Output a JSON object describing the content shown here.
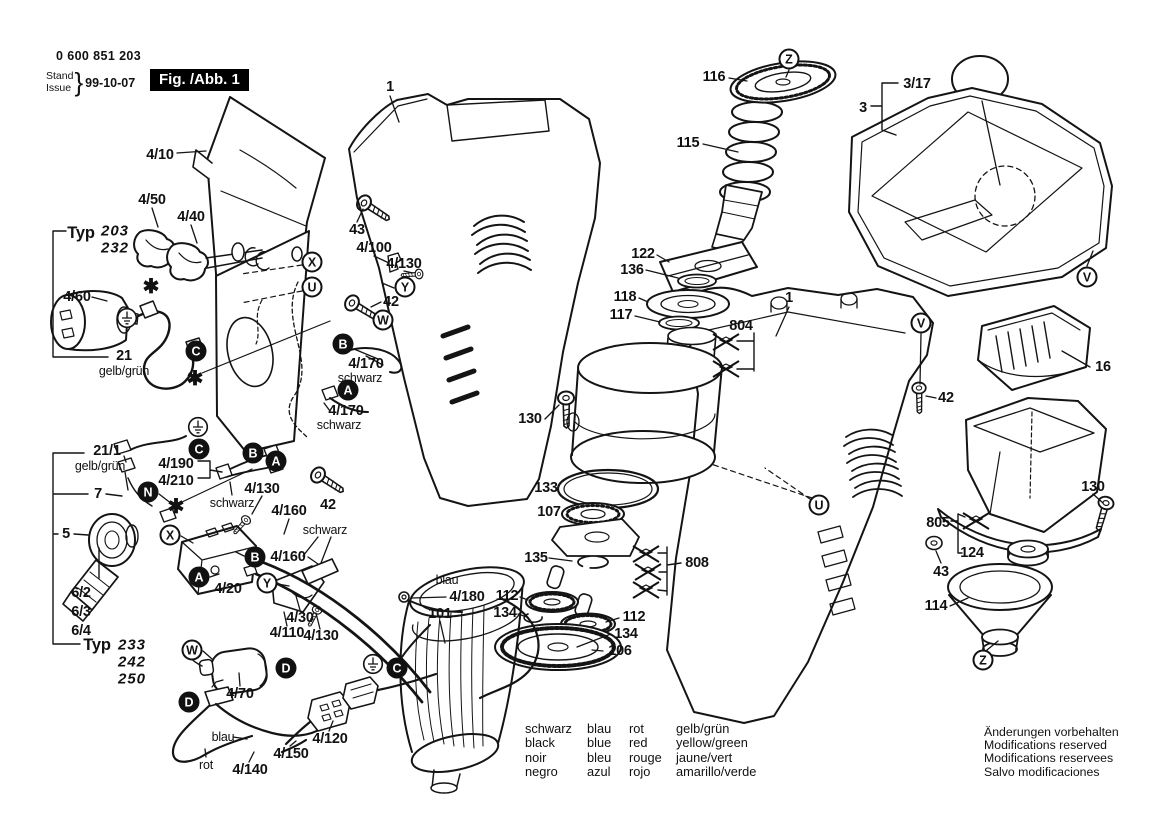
{
  "meta": {
    "part_number": "0 600 851 203",
    "stand_label": "Stand",
    "issue_label": "Issue",
    "brace": "}",
    "date": "99-10-07",
    "figure_label": "Fig. /Abb. 1"
  },
  "colors": {
    "ink": "#141414",
    "paper": "#ffffff"
  },
  "callouts": [
    {
      "text": "4/10",
      "x": 160,
      "y": 155,
      "style": "part"
    },
    {
      "text": "4/50",
      "x": 152,
      "y": 200,
      "style": "part"
    },
    {
      "text": "4/40",
      "x": 191,
      "y": 217,
      "style": "part"
    },
    {
      "text": "Typ",
      "x": 81,
      "y": 233,
      "style": "typ"
    },
    {
      "text": "203",
      "x": 115,
      "y": 231,
      "style": "typnum"
    },
    {
      "text": "232",
      "x": 115,
      "y": 248,
      "style": "typnum"
    },
    {
      "text": "4/60",
      "x": 77,
      "y": 297,
      "style": "part"
    },
    {
      "text": "21",
      "x": 124,
      "y": 356,
      "style": "part"
    },
    {
      "text": "gelb/grün",
      "x": 124,
      "y": 371,
      "style": "color"
    },
    {
      "text": "21/1",
      "x": 107,
      "y": 451,
      "style": "part"
    },
    {
      "text": "gelb/grün",
      "x": 100,
      "y": 466,
      "style": "color"
    },
    {
      "text": "7",
      "x": 98,
      "y": 494,
      "style": "part"
    },
    {
      "text": "5",
      "x": 66,
      "y": 534,
      "style": "part"
    },
    {
      "text": "6/2",
      "x": 81,
      "y": 593,
      "style": "part"
    },
    {
      "text": "6/3",
      "x": 81,
      "y": 612,
      "style": "part"
    },
    {
      "text": "6/4",
      "x": 81,
      "y": 631,
      "style": "part"
    },
    {
      "text": "Typ",
      "x": 97,
      "y": 645,
      "style": "typ"
    },
    {
      "text": "233",
      "x": 132,
      "y": 645,
      "style": "typnum"
    },
    {
      "text": "242",
      "x": 132,
      "y": 662,
      "style": "typnum"
    },
    {
      "text": "250",
      "x": 132,
      "y": 679,
      "style": "typnum"
    },
    {
      "text": "4/190",
      "x": 176,
      "y": 464,
      "style": "part"
    },
    {
      "text": "4/210",
      "x": 176,
      "y": 481,
      "style": "part"
    },
    {
      "text": "schwarz",
      "x": 232,
      "y": 503,
      "style": "color"
    },
    {
      "text": "4/130",
      "x": 262,
      "y": 489,
      "style": "part"
    },
    {
      "text": "4/160",
      "x": 289,
      "y": 511,
      "style": "part"
    },
    {
      "text": "schwarz",
      "x": 325,
      "y": 530,
      "style": "color"
    },
    {
      "text": "4/160",
      "x": 288,
      "y": 557,
      "style": "part"
    },
    {
      "text": "4/20",
      "x": 228,
      "y": 589,
      "style": "part"
    },
    {
      "text": "4/30",
      "x": 300,
      "y": 618,
      "style": "part"
    },
    {
      "text": "4/110",
      "x": 287,
      "y": 633,
      "style": "part"
    },
    {
      "text": "4/130",
      "x": 321,
      "y": 636,
      "style": "part"
    },
    {
      "text": "4/70",
      "x": 240,
      "y": 694,
      "style": "part"
    },
    {
      "text": "blau",
      "x": 223,
      "y": 737,
      "style": "color"
    },
    {
      "text": "rot",
      "x": 206,
      "y": 765,
      "style": "color"
    },
    {
      "text": "4/140",
      "x": 250,
      "y": 770,
      "style": "part"
    },
    {
      "text": "4/150",
      "x": 291,
      "y": 754,
      "style": "part"
    },
    {
      "text": "4/120",
      "x": 330,
      "y": 739,
      "style": "part"
    },
    {
      "text": "blau",
      "x": 447,
      "y": 580,
      "style": "color"
    },
    {
      "text": "4/180",
      "x": 467,
      "y": 597,
      "style": "part"
    },
    {
      "text": "101",
      "x": 440,
      "y": 614,
      "style": "part"
    },
    {
      "text": "42",
      "x": 328,
      "y": 505,
      "style": "part"
    },
    {
      "text": "43",
      "x": 357,
      "y": 230,
      "style": "part"
    },
    {
      "text": "4/100",
      "x": 374,
      "y": 248,
      "style": "part"
    },
    {
      "text": "4/130",
      "x": 404,
      "y": 264,
      "style": "part"
    },
    {
      "text": "42",
      "x": 391,
      "y": 302,
      "style": "part"
    },
    {
      "text": "4/170",
      "x": 366,
      "y": 364,
      "style": "part"
    },
    {
      "text": "schwarz",
      "x": 360,
      "y": 378,
      "style": "color"
    },
    {
      "text": "4/170",
      "x": 346,
      "y": 411,
      "style": "part"
    },
    {
      "text": "schwarz",
      "x": 339,
      "y": 425,
      "style": "color"
    },
    {
      "text": "1",
      "x": 390,
      "y": 87,
      "style": "part"
    },
    {
      "text": "116",
      "x": 714,
      "y": 77,
      "style": "part"
    },
    {
      "text": "115",
      "x": 688,
      "y": 143,
      "style": "part"
    },
    {
      "text": "122",
      "x": 643,
      "y": 254,
      "style": "part"
    },
    {
      "text": "136",
      "x": 632,
      "y": 270,
      "style": "part"
    },
    {
      "text": "118",
      "x": 625,
      "y": 297,
      "style": "part"
    },
    {
      "text": "117",
      "x": 621,
      "y": 315,
      "style": "part"
    },
    {
      "text": "804",
      "x": 741,
      "y": 326,
      "style": "part"
    },
    {
      "text": "1",
      "x": 789,
      "y": 298,
      "style": "part"
    },
    {
      "text": "130",
      "x": 530,
      "y": 419,
      "style": "part"
    },
    {
      "text": "133",
      "x": 546,
      "y": 488,
      "style": "part"
    },
    {
      "text": "107",
      "x": 549,
      "y": 512,
      "style": "part"
    },
    {
      "text": "135",
      "x": 536,
      "y": 558,
      "style": "part"
    },
    {
      "text": "112",
      "x": 507,
      "y": 596,
      "style": "part"
    },
    {
      "text": "134",
      "x": 505,
      "y": 613,
      "style": "part"
    },
    {
      "text": "112",
      "x": 634,
      "y": 617,
      "style": "part"
    },
    {
      "text": "134",
      "x": 626,
      "y": 634,
      "style": "part"
    },
    {
      "text": "106",
      "x": 620,
      "y": 651,
      "style": "part"
    },
    {
      "text": "808",
      "x": 697,
      "y": 563,
      "style": "part"
    },
    {
      "text": "3/17",
      "x": 917,
      "y": 84,
      "style": "part"
    },
    {
      "text": "3",
      "x": 863,
      "y": 108,
      "style": "part"
    },
    {
      "text": "16",
      "x": 1103,
      "y": 367,
      "style": "part"
    },
    {
      "text": "42",
      "x": 946,
      "y": 398,
      "style": "part"
    },
    {
      "text": "130",
      "x": 1093,
      "y": 487,
      "style": "part"
    },
    {
      "text": "805",
      "x": 938,
      "y": 523,
      "style": "part"
    },
    {
      "text": "124",
      "x": 972,
      "y": 553,
      "style": "part"
    },
    {
      "text": "43",
      "x": 941,
      "y": 572,
      "style": "part"
    },
    {
      "text": "114",
      "x": 936,
      "y": 606,
      "style": "part"
    }
  ],
  "connectors": [
    {
      "letter": "C",
      "variant": "filled",
      "x": 196,
      "y": 351
    },
    {
      "letter": "C",
      "variant": "filled",
      "x": 199,
      "y": 449
    },
    {
      "letter": "C",
      "variant": "filled",
      "x": 397,
      "y": 668
    },
    {
      "letter": "B",
      "variant": "filled",
      "x": 253,
      "y": 453
    },
    {
      "letter": "A",
      "variant": "filled",
      "x": 276,
      "y": 461
    },
    {
      "letter": "N",
      "variant": "filled",
      "x": 148,
      "y": 492
    },
    {
      "letter": "B",
      "variant": "filled",
      "x": 255,
      "y": 557
    },
    {
      "letter": "A",
      "variant": "filled",
      "x": 199,
      "y": 577
    },
    {
      "letter": "B",
      "variant": "filled",
      "x": 343,
      "y": 344
    },
    {
      "letter": "A",
      "variant": "filled",
      "x": 348,
      "y": 390
    },
    {
      "letter": "D",
      "variant": "filled",
      "x": 286,
      "y": 668
    },
    {
      "letter": "D",
      "variant": "filled",
      "x": 189,
      "y": 702
    },
    {
      "letter": "X",
      "variant": "outline",
      "x": 312,
      "y": 262
    },
    {
      "letter": "U",
      "variant": "outline",
      "x": 312,
      "y": 287
    },
    {
      "letter": "Y",
      "variant": "outline",
      "x": 405,
      "y": 287
    },
    {
      "letter": "W",
      "variant": "outline",
      "x": 383,
      "y": 320
    },
    {
      "letter": "X",
      "variant": "outline",
      "x": 170,
      "y": 535
    },
    {
      "letter": "Y",
      "variant": "outline",
      "x": 267,
      "y": 583
    },
    {
      "letter": "W",
      "variant": "outline",
      "x": 192,
      "y": 650
    },
    {
      "letter": "Z",
      "variant": "outline",
      "x": 789,
      "y": 59
    },
    {
      "letter": "V",
      "variant": "outline",
      "x": 1087,
      "y": 277
    },
    {
      "letter": "V",
      "variant": "outline",
      "x": 921,
      "y": 323
    },
    {
      "letter": "U",
      "variant": "outline",
      "x": 819,
      "y": 505
    },
    {
      "letter": "Z",
      "variant": "outline",
      "x": 983,
      "y": 660
    }
  ],
  "symbols": [
    {
      "kind": "ground",
      "x": 127,
      "y": 318
    },
    {
      "kind": "ground",
      "x": 198,
      "y": 427
    },
    {
      "kind": "ground",
      "x": 373,
      "y": 664
    },
    {
      "kind": "asterisk",
      "x": 151,
      "y": 287
    },
    {
      "kind": "asterisk",
      "x": 195,
      "y": 379
    },
    {
      "kind": "asterisk",
      "x": 176,
      "y": 507
    },
    {
      "kind": "obsolete",
      "x": 646,
      "y": 554
    },
    {
      "kind": "obsolete",
      "x": 648,
      "y": 572
    },
    {
      "kind": "obsolete",
      "x": 646,
      "y": 590
    },
    {
      "kind": "obsolete",
      "x": 726,
      "y": 342
    },
    {
      "kind": "obsolete",
      "x": 726,
      "y": 369
    },
    {
      "kind": "obsolete",
      "x": 976,
      "y": 521
    }
  ],
  "legend": {
    "rows": [
      [
        "schwarz",
        "blau",
        "rot",
        "gelb/grün"
      ],
      [
        "black",
        "blue",
        "red",
        "yellow/green"
      ],
      [
        "noir",
        "bleu",
        "rouge",
        "jaune/vert"
      ],
      [
        "negro",
        "azul",
        "rojo",
        "amarillo/verde"
      ]
    ]
  },
  "notes": [
    "Änderungen vorbehalten",
    "Modifications reserved",
    "Modifications reservees",
    "Salvo modificaciones"
  ]
}
